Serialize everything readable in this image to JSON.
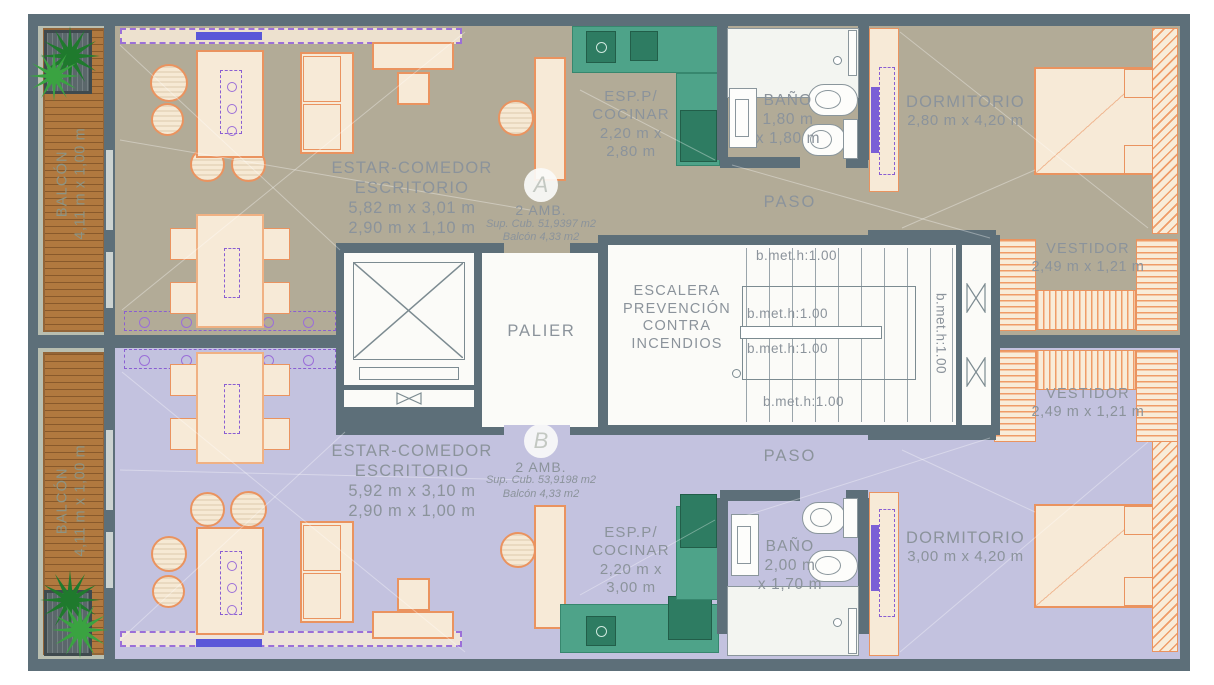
{
  "title": "Two-unit apartment floor plan",
  "colors": {
    "unit_a_floor": "#b2ab97",
    "unit_b_floor": "#c3c2df",
    "wall": "#5d6f79",
    "kitchen_green": "#4ea389",
    "furniture_outline": "#ea935f",
    "furniture_fill": "#f7ead7",
    "wood_deck": "#b1793f",
    "label_gray": "#8b939b",
    "accent_purple": "#7a5fd6",
    "plant_green": "#2e8b36"
  },
  "unit_a": {
    "badge_letter": "A",
    "type_label": "2 AMB.",
    "sup_cub": "Sup. Cub. 51,9397 m2",
    "balcony_sup": "Balcón 4,33 m2",
    "living_line1": "ESTAR-COMEDOR",
    "living_line2": "ESCRITORIO",
    "living_dim1": "5,82 m x 3,01 m",
    "living_dim2": "2,90 m x 1,10 m",
    "kitchen_line1": "ESP.P/",
    "kitchen_line2": "COCINAR",
    "kitchen_dim1": "2,20 m x",
    "kitchen_dim2": "2,80 m",
    "bath_label": "BAÑO",
    "bath_dim1": "1,80 m",
    "bath_dim2": "x 1,80 m",
    "bedroom_label": "DORMITORIO",
    "bedroom_dim": "2,80 m x 4,20 m",
    "paso_label": "PASO",
    "vestidor_label": "VESTIDOR",
    "vestidor_dim": "2,49 m x 1,21 m",
    "balcony_label": "BALCÓN",
    "balcony_dim": "4,11 m x 1,00 m"
  },
  "unit_b": {
    "badge_letter": "B",
    "type_label": "2 AMB.",
    "sup_cub": "Sup. Cub. 53,9198 m2",
    "balcony_sup": "Balcón 4,33 m2",
    "living_line1": "ESTAR-COMEDOR",
    "living_line2": "ESCRITORIO",
    "living_dim1": "5,92 m x 3,10 m",
    "living_dim2": "2,90 m x 1,00 m",
    "kitchen_line1": "ESP.P/",
    "kitchen_line2": "COCINAR",
    "kitchen_dim1": "2,20 m x",
    "kitchen_dim2": "3,00 m",
    "bath_label": "BAÑO",
    "bath_dim1": "2,00 m",
    "bath_dim2": "x 1,70 m",
    "bedroom_label": "DORMITORIO",
    "bedroom_dim": "3,00 m x 4,20 m",
    "paso_label": "PASO",
    "vestidor_label": "VESTIDOR",
    "vestidor_dim": "2,49 m x 1,21 m",
    "balcony_label": "BALCÓN",
    "balcony_dim": "4,11 m x 1,00 m"
  },
  "core": {
    "palier_label": "PALIER",
    "stair_line1": "ESCALERA",
    "stair_line2": "PREVENCIÓN",
    "stair_line3": "CONTRA",
    "stair_line4": "INCENDIOS",
    "rails": [
      "b.met.h:1.00",
      "b.met.h:1.00",
      "b.met.h:1.00",
      "b.met.h:1.00",
      "b.met.h:1.00"
    ]
  }
}
